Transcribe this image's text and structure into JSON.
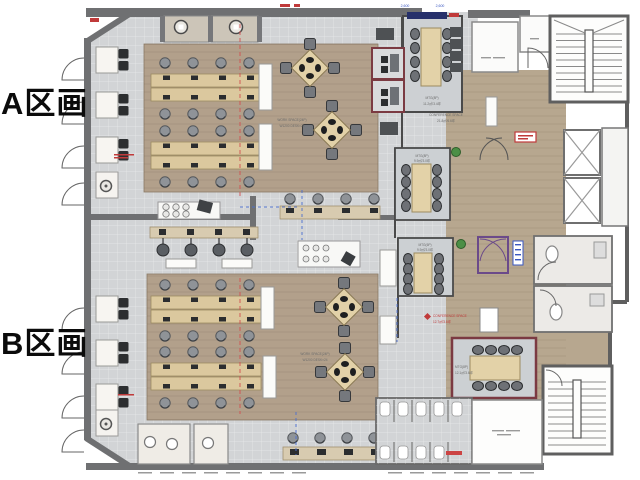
{
  "labels": {
    "section_a": "A区画",
    "section_b": "B区画"
  },
  "rooms": {
    "mtg_a": {
      "name": "MTG(8P)",
      "area": "11.2㎡/3.4坪"
    },
    "conference_space": {
      "name": "CONFERENCE SPACE",
      "area": "21.8㎡/6.6坪"
    },
    "mtg_b": {
      "name": "MTG(8P)",
      "area": "9.9㎡/3.0坪"
    },
    "mtg_c": {
      "name": "MTG(6P)",
      "area": "9.9㎡/3.0坪"
    },
    "mtg_d": {
      "name": "MTG(8P)",
      "area": "12.1㎡/3.6坪"
    },
    "workspace_a": {
      "name": "WORK SPACE(24P)",
      "area": "W1200 DESK×24"
    },
    "workspace_b": {
      "name": "WORK SPACE(24P)",
      "area": "W1200 DESK×24"
    },
    "conference_annex": {
      "name": "CONFERENCE SPACE",
      "area": "12.7㎡/3.8坪"
    }
  },
  "dimensions": {
    "top_left": "2,600",
    "top_right": "2,600"
  },
  "colors": {
    "wall": "#6f7072",
    "tile_floor": "#d2d4d6",
    "wood_floor": "#b2a08b",
    "corridor_floor": "#b7a78f",
    "desk": "#dbc89e",
    "meeting_room_wall": "#7b3a42",
    "vestibule_wall": "#6b4a8a",
    "screen_navy": "#26306b",
    "note_blue": "#3a57c0",
    "note_red": "#c03a3a"
  }
}
